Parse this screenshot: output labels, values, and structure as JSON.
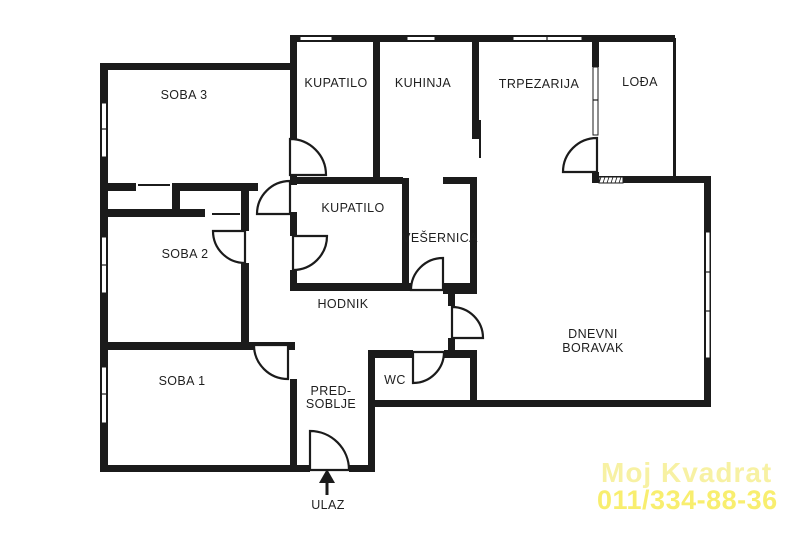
{
  "plan": {
    "title": "apartment-floor-plan",
    "wall_color": "#1b1b1b",
    "background": "#ffffff",
    "rooms": [
      {
        "id": "soba-3",
        "label": "SOBA 3",
        "x": 184,
        "y": 99
      },
      {
        "id": "kupatilo-top",
        "label": "KUPATILO",
        "x": 336,
        "y": 87
      },
      {
        "id": "kuhinja",
        "label": "KUHINJA",
        "x": 423,
        "y": 87
      },
      {
        "id": "trpezarija",
        "label": "TRPEZARIJA",
        "x": 539,
        "y": 88
      },
      {
        "id": "lodja",
        "label": "LOĐA",
        "x": 640,
        "y": 86
      },
      {
        "id": "kupatilo-mid",
        "label": "KUPATILO",
        "x": 353,
        "y": 212
      },
      {
        "id": "vesernica",
        "label": "VEŠERNICA",
        "x": 440,
        "y": 242
      },
      {
        "id": "soba-2",
        "label": "SOBA 2",
        "x": 185,
        "y": 258
      },
      {
        "id": "hodnik",
        "label": "HODNIK",
        "x": 343,
        "y": 308
      },
      {
        "id": "soba-1",
        "label": "SOBA 1",
        "x": 182,
        "y": 385
      },
      {
        "id": "predsoblje",
        "lines": [
          "PRED-",
          "SOBLJE"
        ],
        "x": 331,
        "y": 395,
        "lh": 13
      },
      {
        "id": "wc",
        "label": "WC",
        "x": 395,
        "y": 384
      },
      {
        "id": "dnevni-boravak",
        "lines": [
          "DNEVNI",
          "BORAVAK"
        ],
        "x": 593,
        "y": 338,
        "lh": 14
      },
      {
        "id": "ulaz",
        "label": "ULAZ",
        "x": 328,
        "y": 509
      }
    ],
    "walls": [
      [
        290,
        35,
        385,
        7
      ],
      [
        100,
        63,
        193,
        7
      ],
      [
        100,
        63,
        8,
        409
      ],
      [
        100,
        183,
        36,
        8
      ],
      [
        172,
        183,
        86,
        8
      ],
      [
        172,
        183,
        8,
        33
      ],
      [
        100,
        209,
        105,
        8
      ],
      [
        241,
        183,
        8,
        48
      ],
      [
        241,
        263,
        8,
        87
      ],
      [
        100,
        342,
        195,
        8
      ],
      [
        100,
        465,
        210,
        7
      ],
      [
        349,
        465,
        26,
        7
      ],
      [
        368,
        350,
        7,
        122
      ],
      [
        290,
        35,
        7,
        104
      ],
      [
        290,
        175,
        7,
        10
      ],
      [
        290,
        212,
        7,
        24
      ],
      [
        290,
        270,
        7,
        21
      ],
      [
        290,
        379,
        7,
        93
      ],
      [
        373,
        35,
        7,
        149
      ],
      [
        290,
        177,
        113,
        7
      ],
      [
        443,
        177,
        34,
        7
      ],
      [
        472,
        35,
        7,
        104
      ],
      [
        592,
        35,
        7,
        32
      ],
      [
        592,
        172,
        7,
        11
      ],
      [
        592,
        176,
        119,
        7
      ],
      [
        704,
        177,
        7,
        230
      ],
      [
        368,
        400,
        343,
        7
      ],
      [
        402,
        178,
        7,
        113
      ],
      [
        470,
        177,
        7,
        114
      ],
      [
        293,
        283,
        119,
        8
      ],
      [
        443,
        283,
        34,
        11
      ],
      [
        448,
        291,
        7,
        15
      ],
      [
        448,
        338,
        7,
        20
      ],
      [
        368,
        350,
        45,
        8
      ],
      [
        444,
        350,
        33,
        8
      ],
      [
        470,
        350,
        7,
        57
      ],
      [
        673,
        38,
        3,
        139
      ]
    ],
    "thin_lines": [
      [
        138,
        184,
        32,
        2
      ],
      [
        212,
        213,
        28,
        2
      ],
      [
        479,
        120,
        2,
        38
      ]
    ],
    "windows": [
      {
        "x": 300,
        "y": 36.5,
        "w": 32,
        "h": 4,
        "dir": "h",
        "mullions": []
      },
      {
        "x": 407,
        "y": 36.5,
        "w": 28,
        "h": 4,
        "dir": "h",
        "mullions": []
      },
      {
        "x": 513,
        "y": 36.5,
        "w": 69,
        "h": 4,
        "dir": "h",
        "mullions": [
          547
        ]
      },
      {
        "x": 101.5,
        "y": 103,
        "w": 5,
        "h": 54,
        "dir": "v",
        "mullions": [
          129
        ]
      },
      {
        "x": 101.5,
        "y": 237,
        "w": 5,
        "h": 56,
        "dir": "v",
        "mullions": [
          265
        ]
      },
      {
        "x": 101.5,
        "y": 367,
        "w": 5,
        "h": 56,
        "dir": "v",
        "mullions": [
          394
        ]
      },
      {
        "x": 705.5,
        "y": 232,
        "w": 4.5,
        "h": 126,
        "dir": "v",
        "mullions": [
          272,
          311
        ]
      },
      {
        "x": 593,
        "y": 67,
        "w": 5,
        "h": 68,
        "dir": "v",
        "mullions": [
          100
        ]
      }
    ],
    "hatch": {
      "x": 599,
      "y": 177,
      "w": 24,
      "h": 6,
      "tick_step": 4
    },
    "doors": [
      {
        "id": "door-kupatilo-top",
        "path": "M290,139 A36,36 0 0 1 326,175 L290,175 Z"
      },
      {
        "id": "door-niche",
        "path": "M257,214 A33,33 0 0 1 290,181 L290,214 Z"
      },
      {
        "id": "door-soba-2",
        "path": "M213,231 A32,32 0 0 0 245,263 L245,231 Z"
      },
      {
        "id": "door-soba-1",
        "path": "M254,345 A34,34 0 0 0 288,379 L288,345 Z"
      },
      {
        "id": "door-kupatilo-mid",
        "path": "M327,236 A34,34 0 0 1 293,270 L293,236 Z"
      },
      {
        "id": "door-vesernica",
        "path": "M411,290 A32,32 0 0 1 443,258 L443,290 Z"
      },
      {
        "id": "door-wc",
        "path": "M413,383 A31,31 0 0 0 444,352 L413,352 Z"
      },
      {
        "id": "door-lodja",
        "path": "M563,172 A34,34 0 0 1 597,138 L597,172 Z"
      },
      {
        "id": "door-dnevni",
        "path": "M452,307 A31,31 0 0 1 483,338 L452,338 Z"
      },
      {
        "id": "door-ulaz",
        "path": "M310,431 A39,39 0 0 1 349,470 L310,470 Z"
      }
    ],
    "entrance_arrow": {
      "head": "327,469 319,483 335,483",
      "stem_x": 327,
      "stem_y1": 483,
      "stem_y2": 495
    },
    "watermark": {
      "line1": {
        "text": "Moj Kvadrat",
        "x": 601,
        "y": 482,
        "color": "#f7f1a3"
      },
      "line2": {
        "text": "011/334-88-36",
        "x": 597,
        "y": 509,
        "color": "#f8ee6f"
      }
    }
  }
}
